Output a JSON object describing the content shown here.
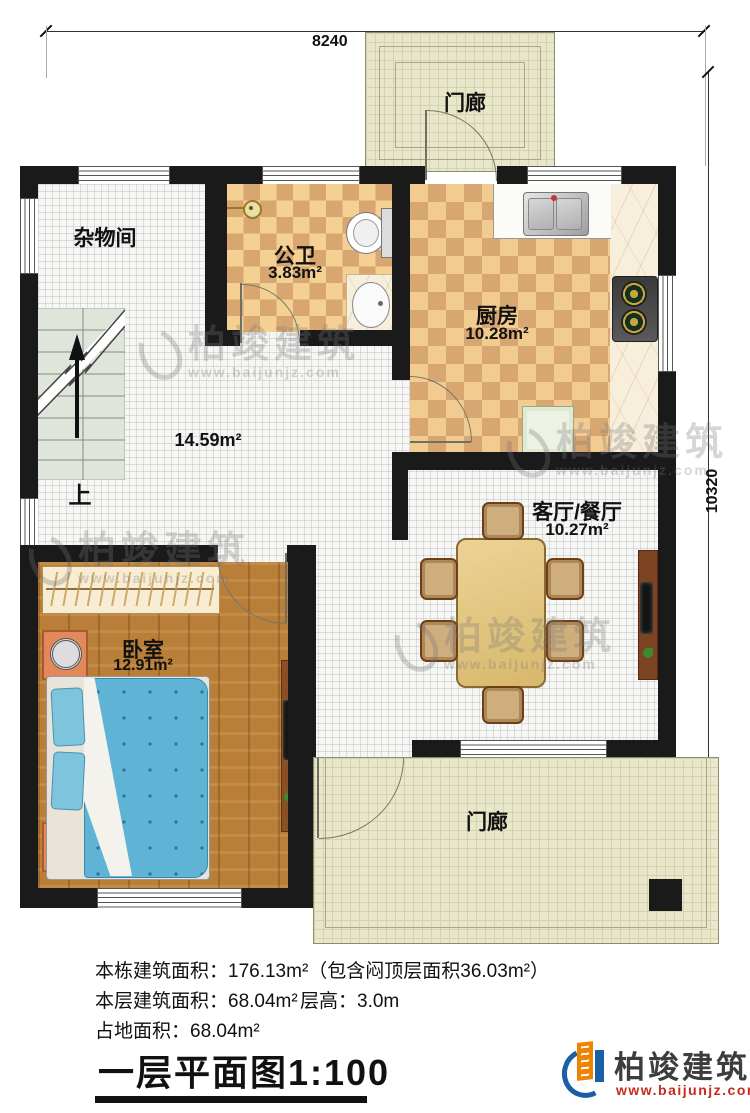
{
  "dimensions": {
    "width_label": "8240",
    "height_label": "10320"
  },
  "rooms": {
    "porch_top": {
      "label": "门廊"
    },
    "storage": {
      "label": "杂物间"
    },
    "bathroom": {
      "label": "公卫",
      "area": "3.83m²"
    },
    "kitchen": {
      "label": "厨房",
      "area": "10.28m²"
    },
    "hall": {
      "area": "14.59m²"
    },
    "living": {
      "label": "客厅/餐厅",
      "area": "10.27m²"
    },
    "bedroom": {
      "label": "卧室",
      "area": "12.91m²"
    },
    "porch_bottom": {
      "label": "门廊"
    },
    "stairs": {
      "up_label": "上"
    }
  },
  "notes": {
    "total_area": "本栋建筑面积：176.13m²（包含闷顶层面积36.03m²）",
    "floor_area": "本层建筑面积：68.04m²",
    "floor_height": "层高：3.0m",
    "footprint": "占地面积：68.04m²"
  },
  "title": "一层平面图1:100",
  "brand": {
    "name": "柏竣建筑",
    "url": "www.baijunjz.com"
  },
  "watermark": {
    "name": "柏竣建筑",
    "url": "www.baijunjz.com"
  },
  "colors": {
    "wall": "#1a1a1a",
    "checker_light": "#f5d093",
    "checker_dark": "#d8a671",
    "wood": "#b97e38",
    "porch": "#e9e7cb",
    "bed_blue": "#5fb4d6",
    "brand_blue": "#1b5fa6",
    "brand_orange": "#f08300",
    "url_red": "#c42b1c"
  }
}
